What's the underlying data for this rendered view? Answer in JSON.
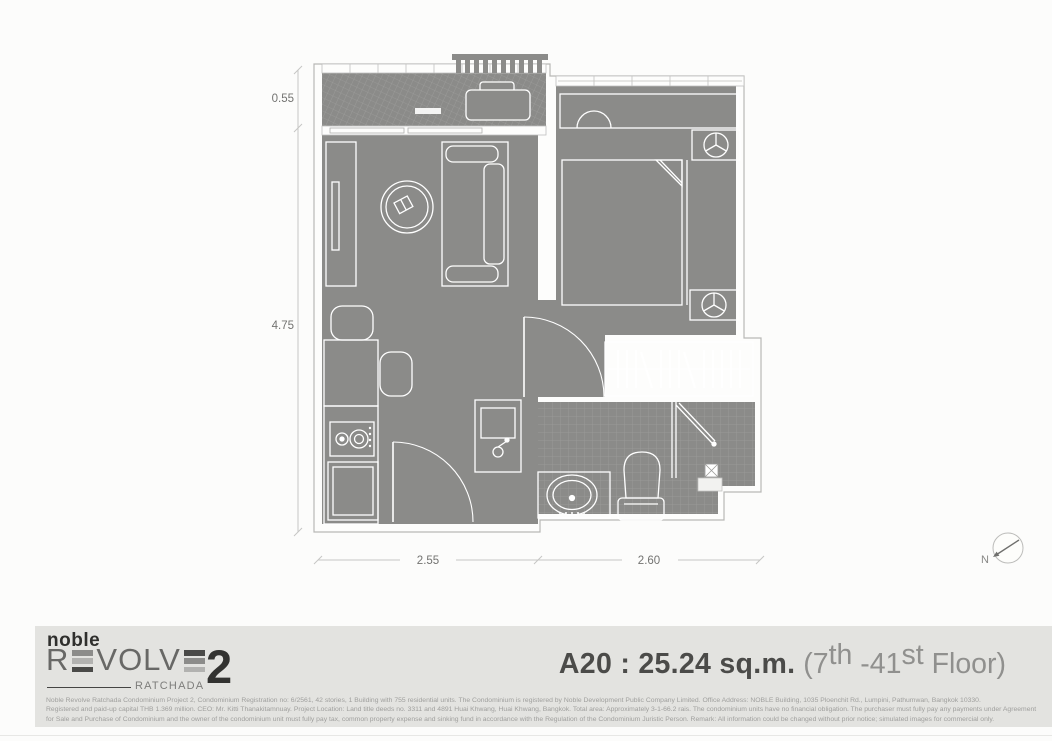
{
  "floorplan": {
    "dimensions": {
      "left_top": "0.55",
      "left_bottom": "4.75",
      "bottom_left": "2.55",
      "bottom_right": "2.60"
    },
    "north_label": "N"
  },
  "footer": {
    "logo": {
      "brand": "noble",
      "name_r": "R",
      "name_volv": "VOLV",
      "number": "2",
      "subtitle": "RATCHADA"
    },
    "title": {
      "unit": "A20 : 25.24 sq.m.",
      "floor_open": " (7",
      "floor_sup_th": "th",
      "floor_dash": " -41",
      "floor_sup_st": "st",
      "floor_close": " Floor)"
    },
    "disclaimer": {
      "line1": "Noble Revolve Ratchada Condominium Project 2, Condominium Registration no: 6/2561, 42 stories, 1 Building with 755 residential units. The Condominium is registered by Noble Development Public Company Limited. Office Address: NOBLE Building, 1035 Ploenchit Rd., Lumpini, Pathumwan, Bangkok 10330.",
      "line2": "Registered and paid-up capital THB 1.369 million. CEO: Mr. Kitti Thanakitamnuay. Project Location: Land title deeds no. 3311 and 4891 Huai Khwang, Huai Khwang, Bangkok. Total area: Approximately 3-1-66.2 rais. The condominium units have no financial obligation. The purchaser must fully pay any payments under Agreement",
      "line3": "for Sale and Purchase of Condominium and the owner of the condominium unit must fully pay tax, common property expense and sinking fund in accordance with the Regulation of the Condominium Juristic Person. Remark: All information could be changed without prior notice; simulated images for commercial only."
    }
  },
  "colors": {
    "plan_gray": "#8b8b89",
    "tile_line": "#9e9e9c",
    "band_bg": "#e3e3e0",
    "logo_dark": "#2f2f2d",
    "logo_gray": "#686866",
    "title_dark": "#4b4b49",
    "title_light": "#90908e",
    "disclaimer_gray": "#9f9f9d"
  }
}
